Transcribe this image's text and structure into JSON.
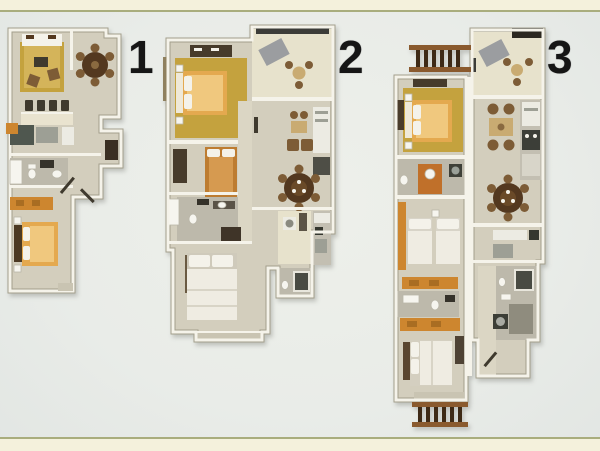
{
  "plans": [
    {
      "label": "1"
    },
    {
      "label": "2"
    },
    {
      "label": "3"
    }
  ],
  "colors": {
    "band": "#f4f1dc",
    "band-line": "#a9ad7d",
    "floor": "#d3cebd",
    "floor-light": "#e7e2cc",
    "wall": "#f5f3ea",
    "wall-edge": "#a39f8c",
    "rug-gold": "#c4a23e",
    "rug-gold-light": "#d4b45a",
    "bed-orange": "#e4a94f",
    "bed-orange-light": "#f0c87e",
    "bed-dark-orange": "#bd7c31",
    "dresser-orange": "#cd862f",
    "wood-dark": "#53381f",
    "wood-mid": "#7d5c36",
    "furn-dark": "#3f3a2e",
    "white-soft": "#f4f2ea",
    "gray-appliance": "#9d9f95",
    "label": "#161616"
  }
}
